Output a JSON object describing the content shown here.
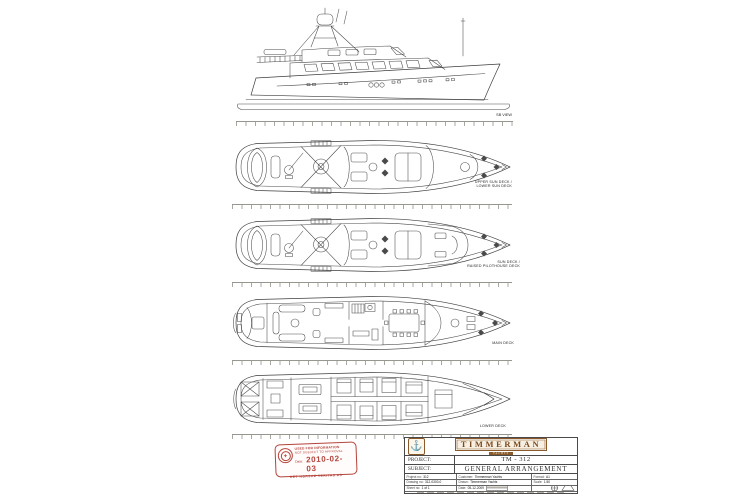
{
  "side_view": {
    "label": "SB VIEW"
  },
  "decks": [
    {
      "label1": "UPPER SUN DECK /",
      "label2": "LOWER SUN DECK"
    },
    {
      "label1": "SUN DECK /",
      "label2": "RAISED PILOTHOUSE DECK"
    },
    {
      "label1": "MAIN DECK",
      "label2": ""
    },
    {
      "label1": "LOWER DECK",
      "label2": ""
    }
  ],
  "stamp": {
    "line1": "USED FOR INFORMATION",
    "line2": "NOT SUBJECT TO APPROVAL",
    "date_label": "Date:",
    "date_value": "2010-02-03",
    "footer": "DET NORSKE VERITAS AS",
    "color": "#b5443c"
  },
  "title_block": {
    "brand": "TIMMERMAN",
    "brand_sub": "YACHTS",
    "project_label": "PROJECT:",
    "project_value": "TM - 312",
    "subject_label": "SUBJECT:",
    "subject_value": "GENERAL ARRANGEMENT",
    "accent_color": "#8a5a2b",
    "rows": [
      [
        {
          "label": "Project no:",
          "value": "312"
        },
        {
          "label": "Customer:",
          "value": "Timmerman Yachts"
        },
        {
          "label": "Format:",
          "value": "A1"
        }
      ],
      [
        {
          "label": "Drawing no:",
          "value": "312-0300-0"
        },
        {
          "label": "Drawn:",
          "value": "Timmerman Yachts"
        },
        {
          "label": "Scale:",
          "value": "1:50"
        }
      ],
      [
        {
          "label": "Sheet no:",
          "value": "1 of 1"
        },
        {
          "label": "Date:",
          "value": "05-12-2009"
        },
        {
          "label": "",
          "value": ""
        }
      ]
    ]
  }
}
